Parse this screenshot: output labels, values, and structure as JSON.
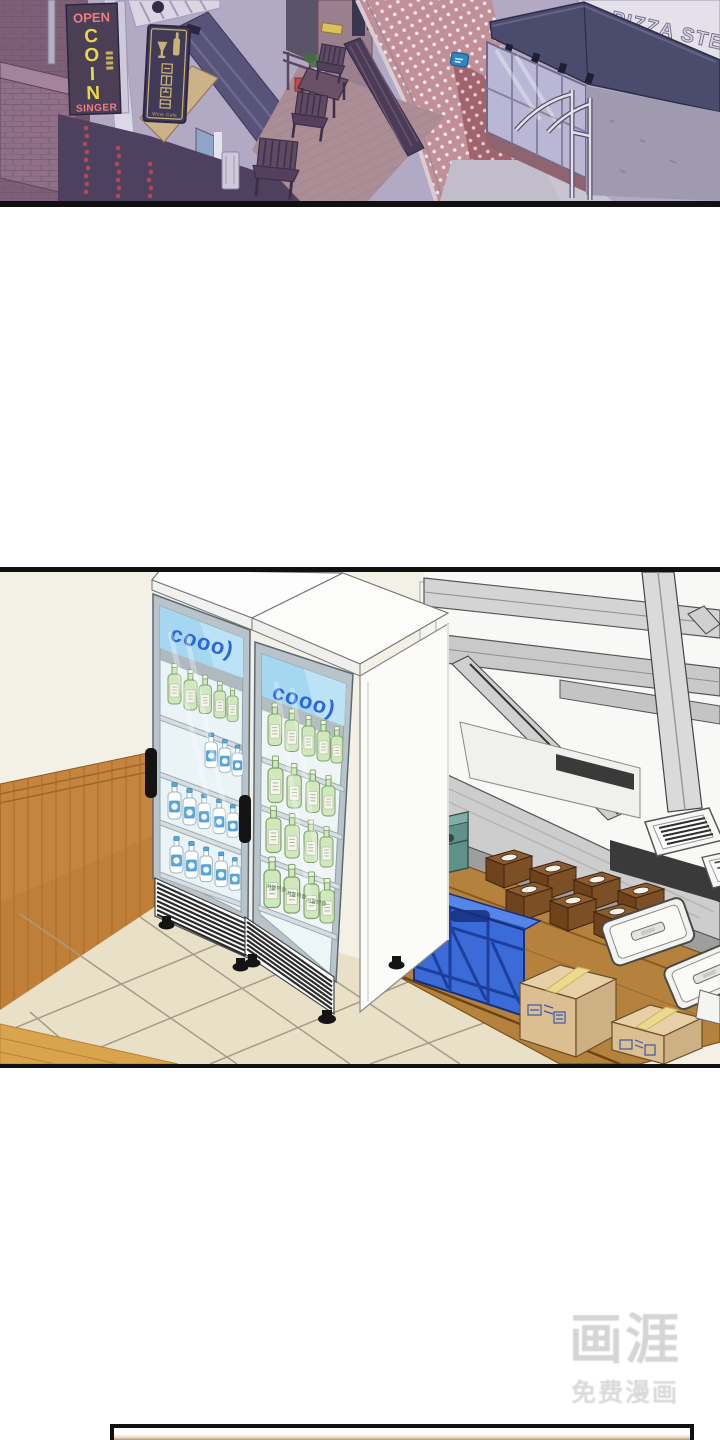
{
  "street_panel": {
    "karaoke_sign": {
      "open": "OPEN",
      "letters": [
        "C",
        "O",
        "I",
        "N"
      ],
      "bottom": "SINGER"
    },
    "wine_sign": {
      "caption": "Wine Cafe"
    },
    "pizza_sign": {
      "text": "PIZZA STE"
    }
  },
  "stockroom_panel": {
    "fridge_brand": "cooo)",
    "bottle_label": "처음이슬",
    "colors": {
      "brand_blue": "#2c67d6",
      "header_blue": "#a6d7f1",
      "crate_blue": "#3a6bd6",
      "crate_teal": "#5f9188",
      "wood": "#c5853e"
    }
  },
  "watermark": {
    "logo": "画涯",
    "subtitle": "免费漫画"
  }
}
